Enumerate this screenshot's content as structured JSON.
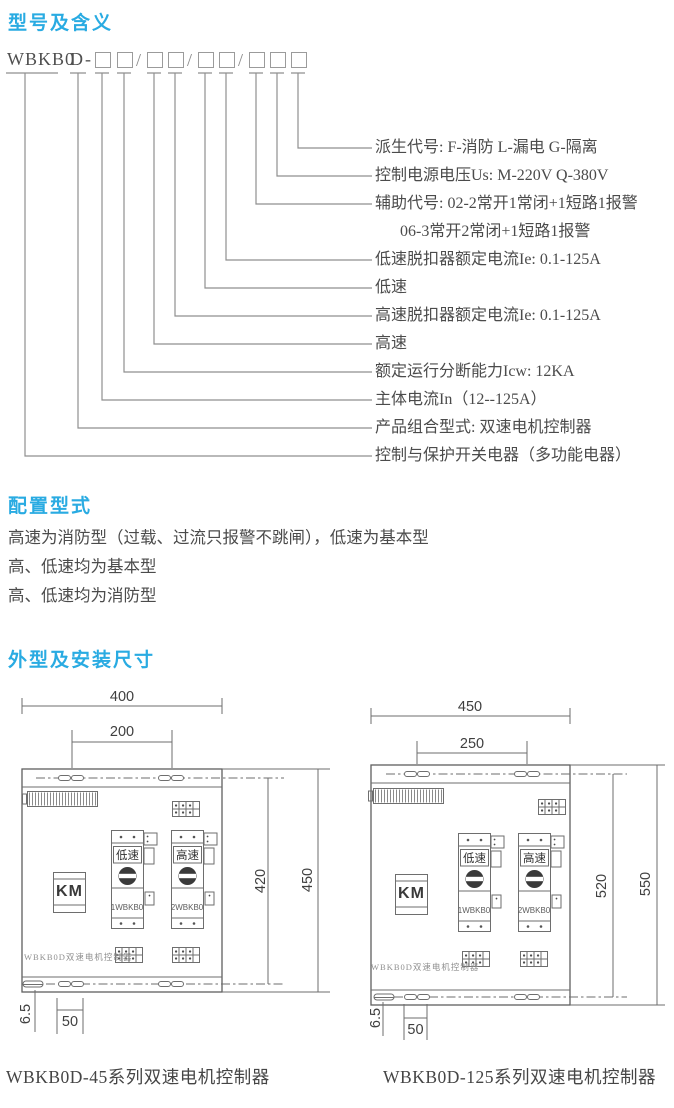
{
  "accent": "#29abe2",
  "sections": {
    "model": {
      "heading": "型号及含义",
      "code": {
        "prefix": "WBKB0",
        "type": "D",
        "dash": "-",
        "slash": "/"
      },
      "labels": [
        "派生代号: F-消防 L-漏电 G-隔离",
        "控制电源电压Us: M-220V Q-380V",
        "辅助代号: 02-2常开1常闭+1短路1报警",
        "06-3常开2常闭+1短路1报警",
        "低速脱扣器额定电流Ie: 0.1-125A",
        "低速",
        "高速脱扣器额定电流Ie: 0.1-125A",
        "高速",
        "额定运行分断能力Icw: 12KA",
        "主体电流In（12--125A）",
        "产品组合型式: 双速电机控制器",
        "控制与保护开关电器（多功能电器）"
      ]
    },
    "config": {
      "heading": "配置型式",
      "lines": [
        "高速为消防型（过载、过流只报警不跳闸），低速为基本型",
        "高、低速均为基本型",
        "高、低速均为消防型"
      ]
    },
    "outline": {
      "heading": "外型及安装尺寸",
      "drawings": [
        {
          "caption": "WBKB0D-45系列双速电机控制器",
          "dims": {
            "width": "400",
            "mount_w": "200",
            "mount_h": "420",
            "height": "450",
            "slot": "6.5",
            "offset": "50"
          },
          "parts": {
            "low": "低速",
            "high": "高速",
            "contactor": "KM",
            "unit1": "1WBKB0",
            "unit2": "2WBKB0",
            "board": "WBKB0D双速电机控制器"
          }
        },
        {
          "caption": "WBKB0D-125系列双速电机控制器",
          "dims": {
            "width": "450",
            "mount_w": "250",
            "mount_h": "520",
            "height": "550",
            "slot": "6.5",
            "offset": "50"
          },
          "parts": {
            "low": "低速",
            "high": "高速",
            "contactor": "KM",
            "unit1": "1WBKB0",
            "unit2": "2WBKB0",
            "board": "WBKB0D双速电机控制器"
          }
        }
      ]
    }
  }
}
